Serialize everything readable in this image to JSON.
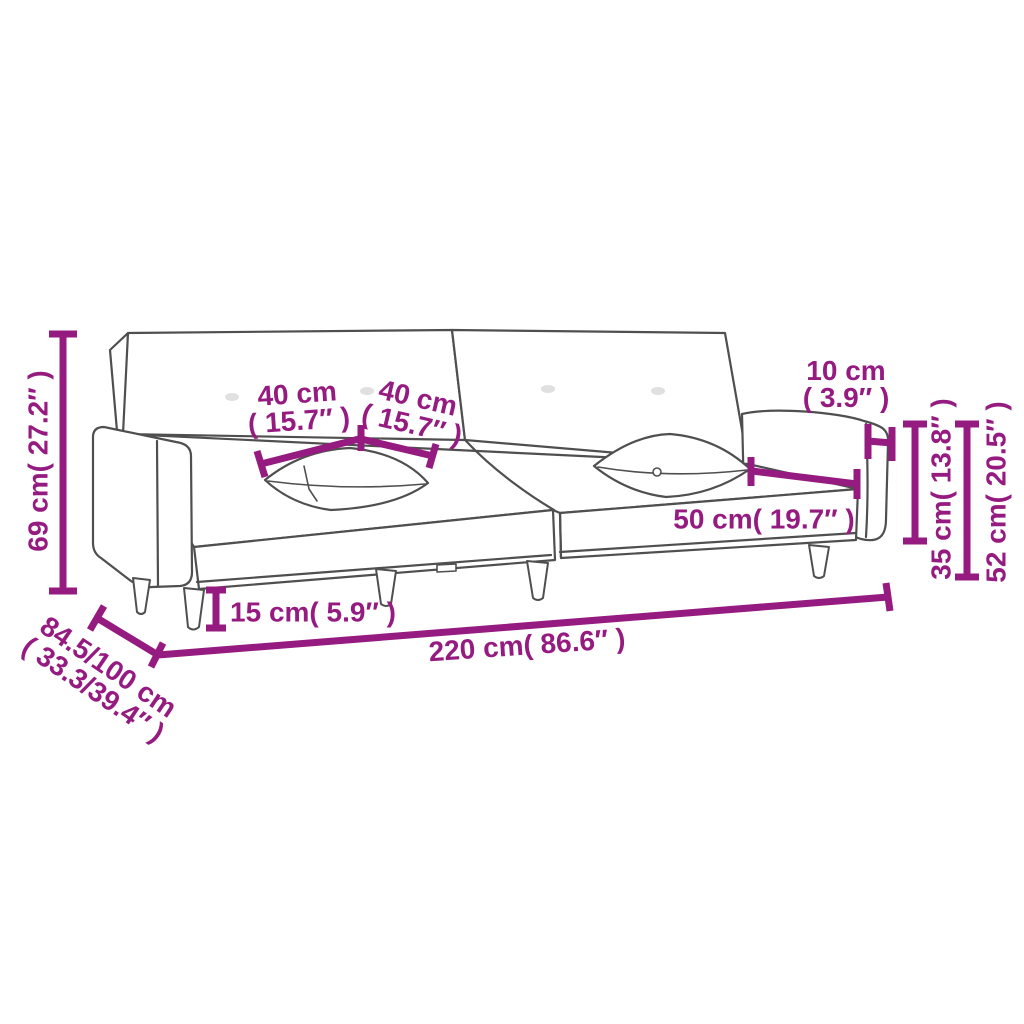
{
  "colors": {
    "accent": "#951B81",
    "outline": "#4F4F4F",
    "background": "#FFFFFF"
  },
  "dimensions": {
    "height": {
      "text": "69 cm( 27.2″ )"
    },
    "pillow_left": {
      "line1": "40 cm",
      "line2": "( 15.7″ )"
    },
    "pillow_right": {
      "line1": "40 cm",
      "line2": "( 15.7″ )"
    },
    "armrest_width": {
      "line1": "10 cm",
      "line2": "( 3.9″ )"
    },
    "armrest_height": {
      "text": "35 cm( 13.8″ )"
    },
    "side_height": {
      "text": "52 cm( 20.5″ )"
    },
    "seat_depth": {
      "text": "50 cm( 19.7″ )"
    },
    "leg_height": {
      "text": "15 cm( 5.9″ )"
    },
    "length": {
      "text": "220 cm( 86.6″ )"
    },
    "depth": {
      "line1": "84.5/100 cm",
      "line2": "( 33.3/39.4″ )"
    }
  }
}
